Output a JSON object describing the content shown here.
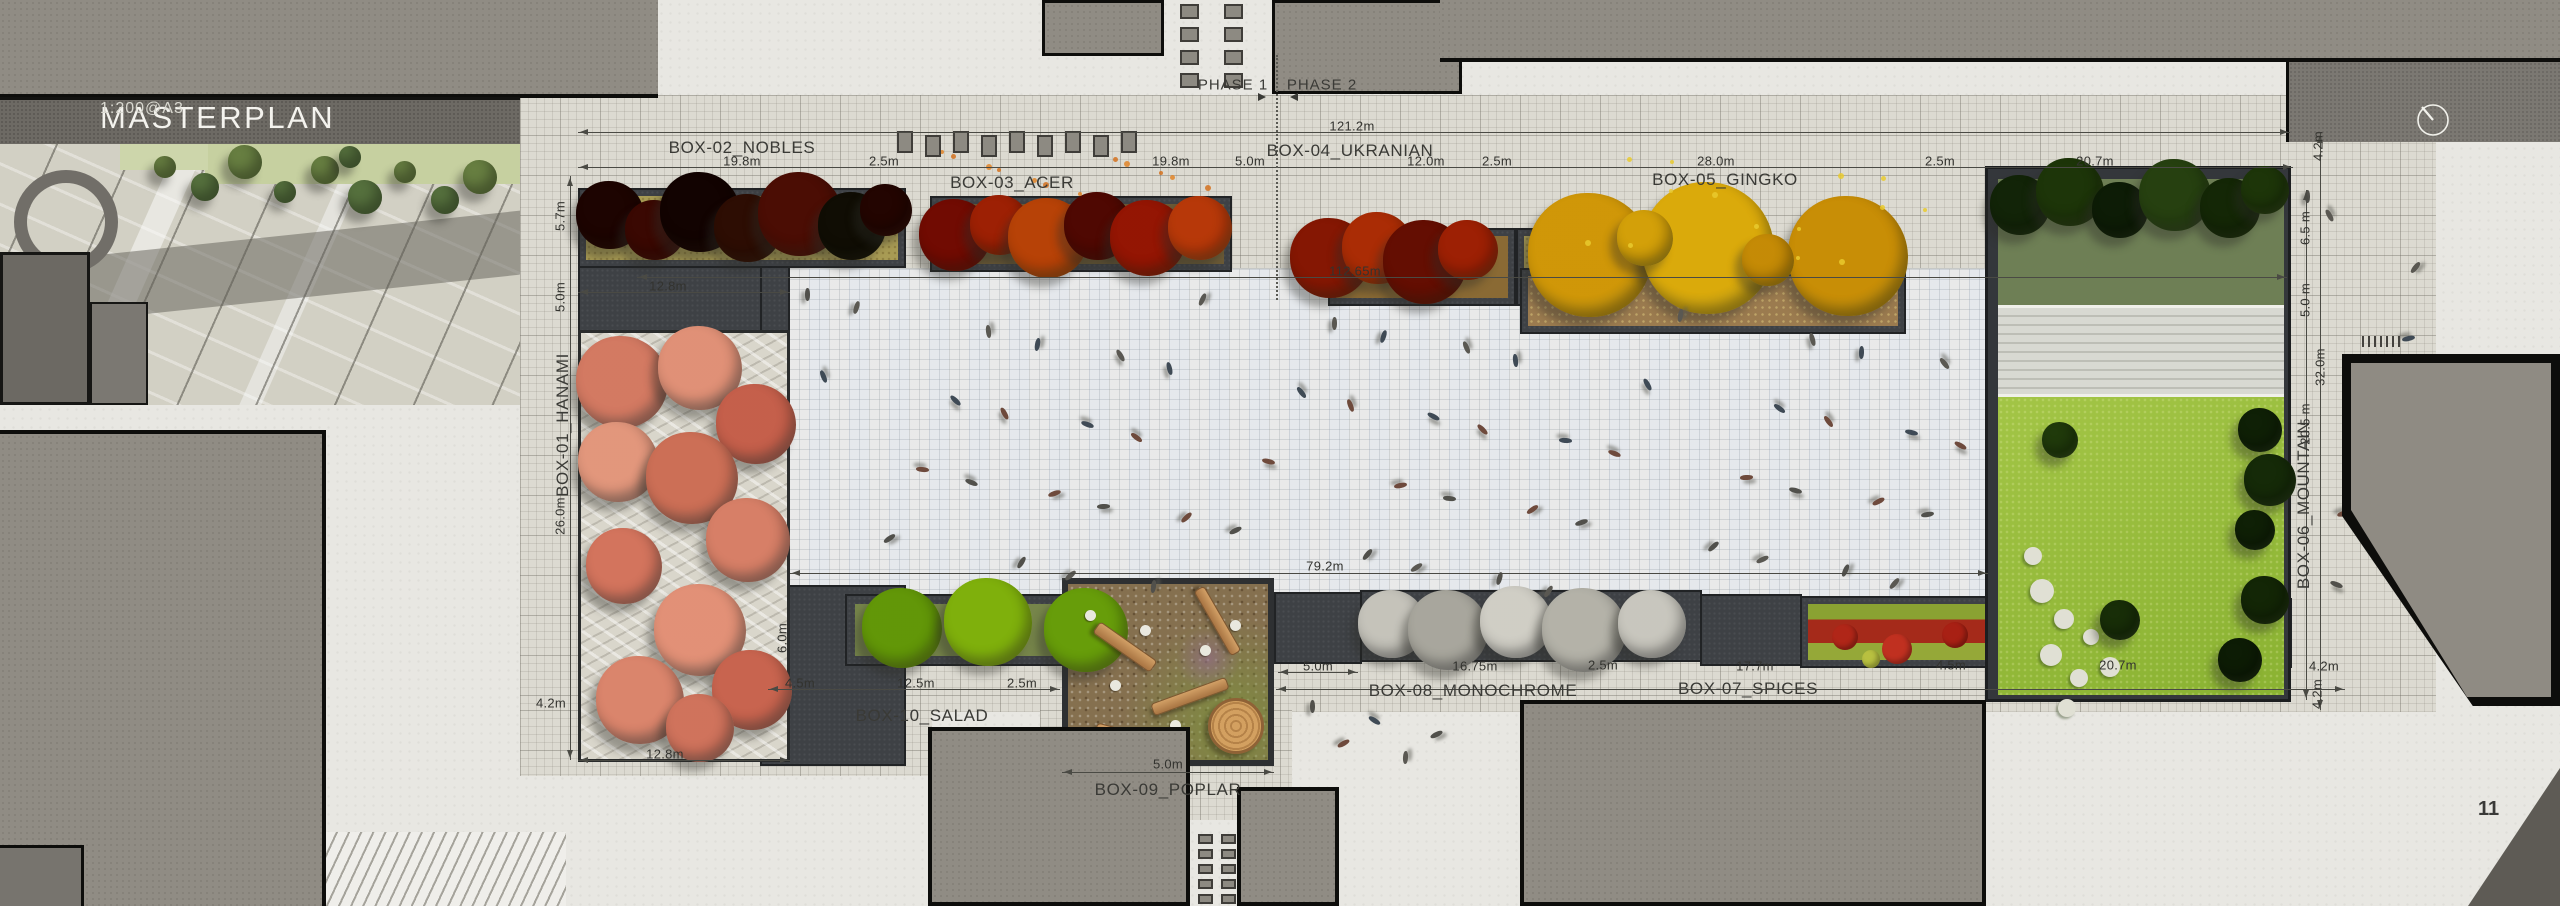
{
  "title": {
    "main": "MASTERPLAN",
    "scale": "1:200@A3"
  },
  "page_number": "11",
  "phase_labels": {
    "phase1": "PHASE 1",
    "phase2": "PHASE 2"
  },
  "colors": {
    "paper": "#e8e7e2",
    "building": "#908c84",
    "planter_charcoal": "#3e4145",
    "plaza": "#eceef0",
    "apron": "#dcdad1",
    "lawn": "#9ec23c",
    "hanami_pink": "#e8b09e",
    "gingko_yellow": "#e6c42c",
    "acer_orange": "#c85a1e",
    "nobles_maroon": "#6b2418",
    "salad_green": "#a6c832",
    "monochrome_white": "#dcdcd6",
    "spices_red": "#b02618"
  },
  "box_labels": [
    {
      "id": "box-01",
      "text": "BOX-01_HANAMI",
      "x": 563,
      "y": 425,
      "rot": true
    },
    {
      "id": "box-02",
      "text": "BOX-02_NOBLES",
      "x": 742,
      "y": 148
    },
    {
      "id": "box-03",
      "text": "BOX-03_ACER",
      "x": 1012,
      "y": 183
    },
    {
      "id": "box-04",
      "text": "BOX-04_UKRANIAN",
      "x": 1350,
      "y": 151
    },
    {
      "id": "box-05",
      "text": "BOX-05_GINGKO",
      "x": 1725,
      "y": 180
    },
    {
      "id": "box-06",
      "text": "BOX-06_MOUNTAIN",
      "x": 2304,
      "y": 505,
      "rot": true
    },
    {
      "id": "box-07",
      "text": "BOX-07_SPICES",
      "x": 1748,
      "y": 689
    },
    {
      "id": "box-08",
      "text": "BOX-08_MONOCHROME",
      "x": 1473,
      "y": 691
    },
    {
      "id": "box-09",
      "text": "BOX-09_POPLAR",
      "x": 1168,
      "y": 790
    },
    {
      "id": "box-10",
      "text": "BOX-10_SALAD",
      "x": 922,
      "y": 716
    }
  ],
  "dimensions": [
    {
      "id": "overall-width",
      "text": "121.2m",
      "x": 1352,
      "y": 126
    },
    {
      "id": "top-19-8-a",
      "text": "19.8m",
      "x": 742,
      "y": 161
    },
    {
      "id": "top-2-5-a",
      "text": "2.5m",
      "x": 884,
      "y": 161
    },
    {
      "id": "top-19-8-b",
      "text": "19.8m",
      "x": 1171,
      "y": 161
    },
    {
      "id": "top-5-0",
      "text": "5.0m",
      "x": 1250,
      "y": 161
    },
    {
      "id": "top-12-0",
      "text": "12.0m",
      "x": 1426,
      "y": 161
    },
    {
      "id": "top-2-5-b",
      "text": "2.5m",
      "x": 1497,
      "y": 161
    },
    {
      "id": "top-28-0",
      "text": "28.0m",
      "x": 1716,
      "y": 161
    },
    {
      "id": "top-2-5-c",
      "text": "2.5m",
      "x": 1940,
      "y": 161
    },
    {
      "id": "top-20-7",
      "text": "20.7m",
      "x": 2095,
      "y": 161
    },
    {
      "id": "inner-width",
      "text": "112.65m",
      "x": 1355,
      "y": 271
    },
    {
      "id": "plaza-width",
      "text": "79.2m",
      "x": 1325,
      "y": 566
    },
    {
      "id": "left-5-7",
      "text": "5.7m",
      "x": 560,
      "y": 216,
      "rot": true
    },
    {
      "id": "left-5-0",
      "text": "5.0m",
      "x": 560,
      "y": 297,
      "rot": true
    },
    {
      "id": "left-26-0",
      "text": "26.0m",
      "x": 560,
      "y": 516,
      "rot": true
    },
    {
      "id": "left-4-2",
      "text": "4.2m",
      "x": 551,
      "y": 703
    },
    {
      "id": "hanami-12-8-top",
      "text": "12.8m",
      "x": 668,
      "y": 286
    },
    {
      "id": "hanami-12-8-bot",
      "text": "12.8m",
      "x": 665,
      "y": 754
    },
    {
      "id": "salad-6-0",
      "text": "6.0m",
      "x": 782,
      "y": 638,
      "rot": true
    },
    {
      "id": "bot-4-5-a",
      "text": "4.5m",
      "x": 800,
      "y": 683
    },
    {
      "id": "bot-12-5",
      "text": "12.5m",
      "x": 916,
      "y": 683
    },
    {
      "id": "bot-2-5-a",
      "text": "2.5m",
      "x": 1022,
      "y": 683
    },
    {
      "id": "poplar-5-0-side",
      "text": "5.0m",
      "x": 1318,
      "y": 666
    },
    {
      "id": "poplar-5-0-bot",
      "text": "5.0m",
      "x": 1168,
      "y": 764
    },
    {
      "id": "bot-16-75",
      "text": "16.75m",
      "x": 1475,
      "y": 666
    },
    {
      "id": "bot-2-5-b",
      "text": "2.5m",
      "x": 1603,
      "y": 665
    },
    {
      "id": "bot-17-7",
      "text": "17.7m",
      "x": 1755,
      "y": 666
    },
    {
      "id": "bot-4-5-b",
      "text": "4.5m",
      "x": 1951,
      "y": 665
    },
    {
      "id": "bot-20-7",
      "text": "20.7m",
      "x": 2118,
      "y": 665
    },
    {
      "id": "bot-4-2-h",
      "text": "4.2m",
      "x": 2324,
      "y": 666
    },
    {
      "id": "bot-4-2-v",
      "text": "4.2m",
      "x": 2317,
      "y": 694,
      "rot": true
    },
    {
      "id": "right-4-2-top",
      "text": "4.2m",
      "x": 2318,
      "y": 146,
      "rot": true
    },
    {
      "id": "right-6-5",
      "text": "6.5 m",
      "x": 2305,
      "y": 228,
      "rot": true
    },
    {
      "id": "right-5-0",
      "text": "5.0 m",
      "x": 2305,
      "y": 300,
      "rot": true
    },
    {
      "id": "right-32-0",
      "text": "32.0m",
      "x": 2320,
      "y": 367,
      "rot": true
    },
    {
      "id": "right-20-5",
      "text": "20.5 m",
      "x": 2305,
      "y": 424,
      "rot": true
    }
  ]
}
